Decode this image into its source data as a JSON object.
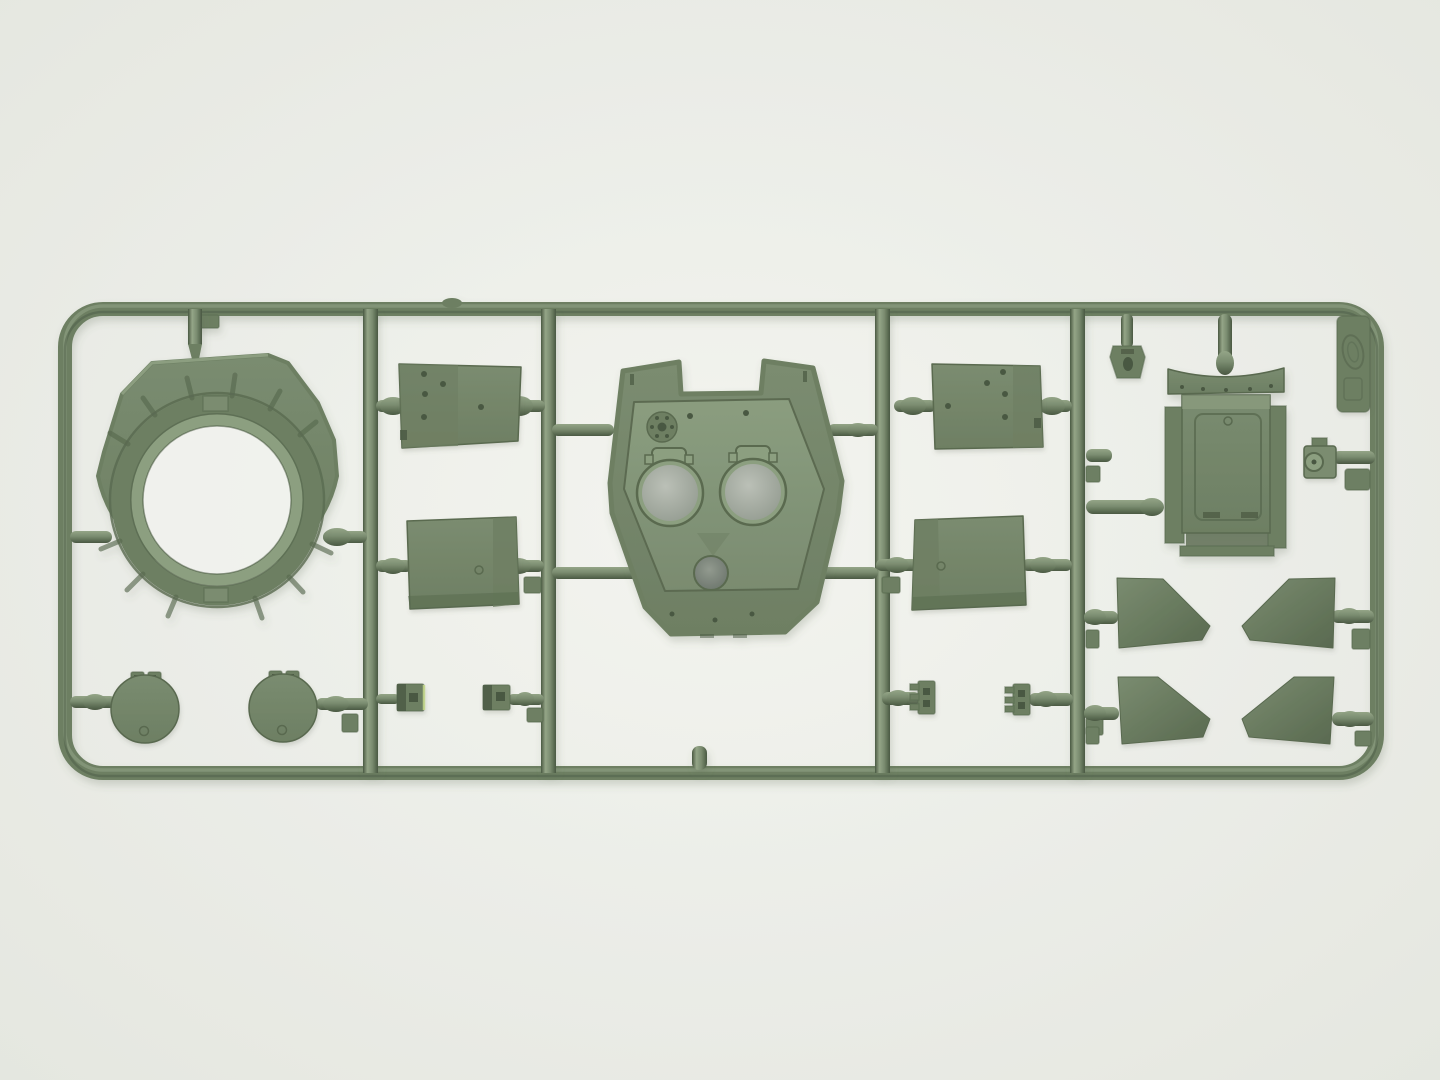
{
  "scene": {
    "subject": "olive-green injection-molded plastic model kit sprue (runner frame) with tank turret parts, photographed on a plain light backdrop",
    "orientation": "horizontal rectangular frame with five vertical runners"
  },
  "colors": {
    "background_center": "#f4f5f1",
    "background_edge": "#e7e9e3",
    "plastic_base": "#7b8d71",
    "plastic_light": "#95a688",
    "plastic_panel": "#8da081",
    "plastic_mid": "#6e8064",
    "plastic_dark": "#5a6a50",
    "plastic_deep": "#4a5942",
    "metal_light": "#bcc1b8",
    "metal_dark": "#939b90",
    "hole_dark": "#6a746a",
    "accent_lime": "#c9dc8e",
    "hole_backdrop": "#f2f3ef"
  },
  "parts": [
    {
      "name": "turret-ring",
      "label": "large turret ring with ribbed flange"
    },
    {
      "name": "hatch-disc-left",
      "label": "round hatch lid with hinge tabs"
    },
    {
      "name": "hatch-disc-right",
      "label": "round hatch lid with hinge tabs"
    },
    {
      "name": "stowage-box-a",
      "label": "riveted stowage box (upper left pair)"
    },
    {
      "name": "stowage-box-b",
      "label": "plain stowage box (lower left pair)"
    },
    {
      "name": "turret-roof",
      "label": "turret roof plate with two periscope openings and round port"
    },
    {
      "name": "stowage-box-c",
      "label": "riveted stowage box (upper right pair, mirrored)"
    },
    {
      "name": "stowage-box-d",
      "label": "plain stowage box (lower right pair, mirrored)"
    },
    {
      "name": "rear-bin",
      "label": "rectangular rear bin with side flanges"
    },
    {
      "name": "small-bracket",
      "label": "small bracket hanging from top rail"
    },
    {
      "name": "periscope-block",
      "label": "small periscope block with lens"
    },
    {
      "name": "brand-tab",
      "label": "embossed maker tab in top-right corner"
    },
    {
      "name": "mud-flap-tl",
      "label": "angled fender plate"
    },
    {
      "name": "mud-flap-tr",
      "label": "angled fender plate (mirrored)"
    },
    {
      "name": "mud-flap-bl",
      "label": "angled fender plate"
    },
    {
      "name": "mud-flap-br",
      "label": "angled fender plate (mirrored)"
    },
    {
      "name": "clamp-1",
      "label": "tiny clamp part"
    },
    {
      "name": "clamp-2",
      "label": "tiny clamp part"
    },
    {
      "name": "clamp-3",
      "label": "tiny hinge part"
    },
    {
      "name": "clamp-4",
      "label": "tiny hinge part"
    }
  ]
}
